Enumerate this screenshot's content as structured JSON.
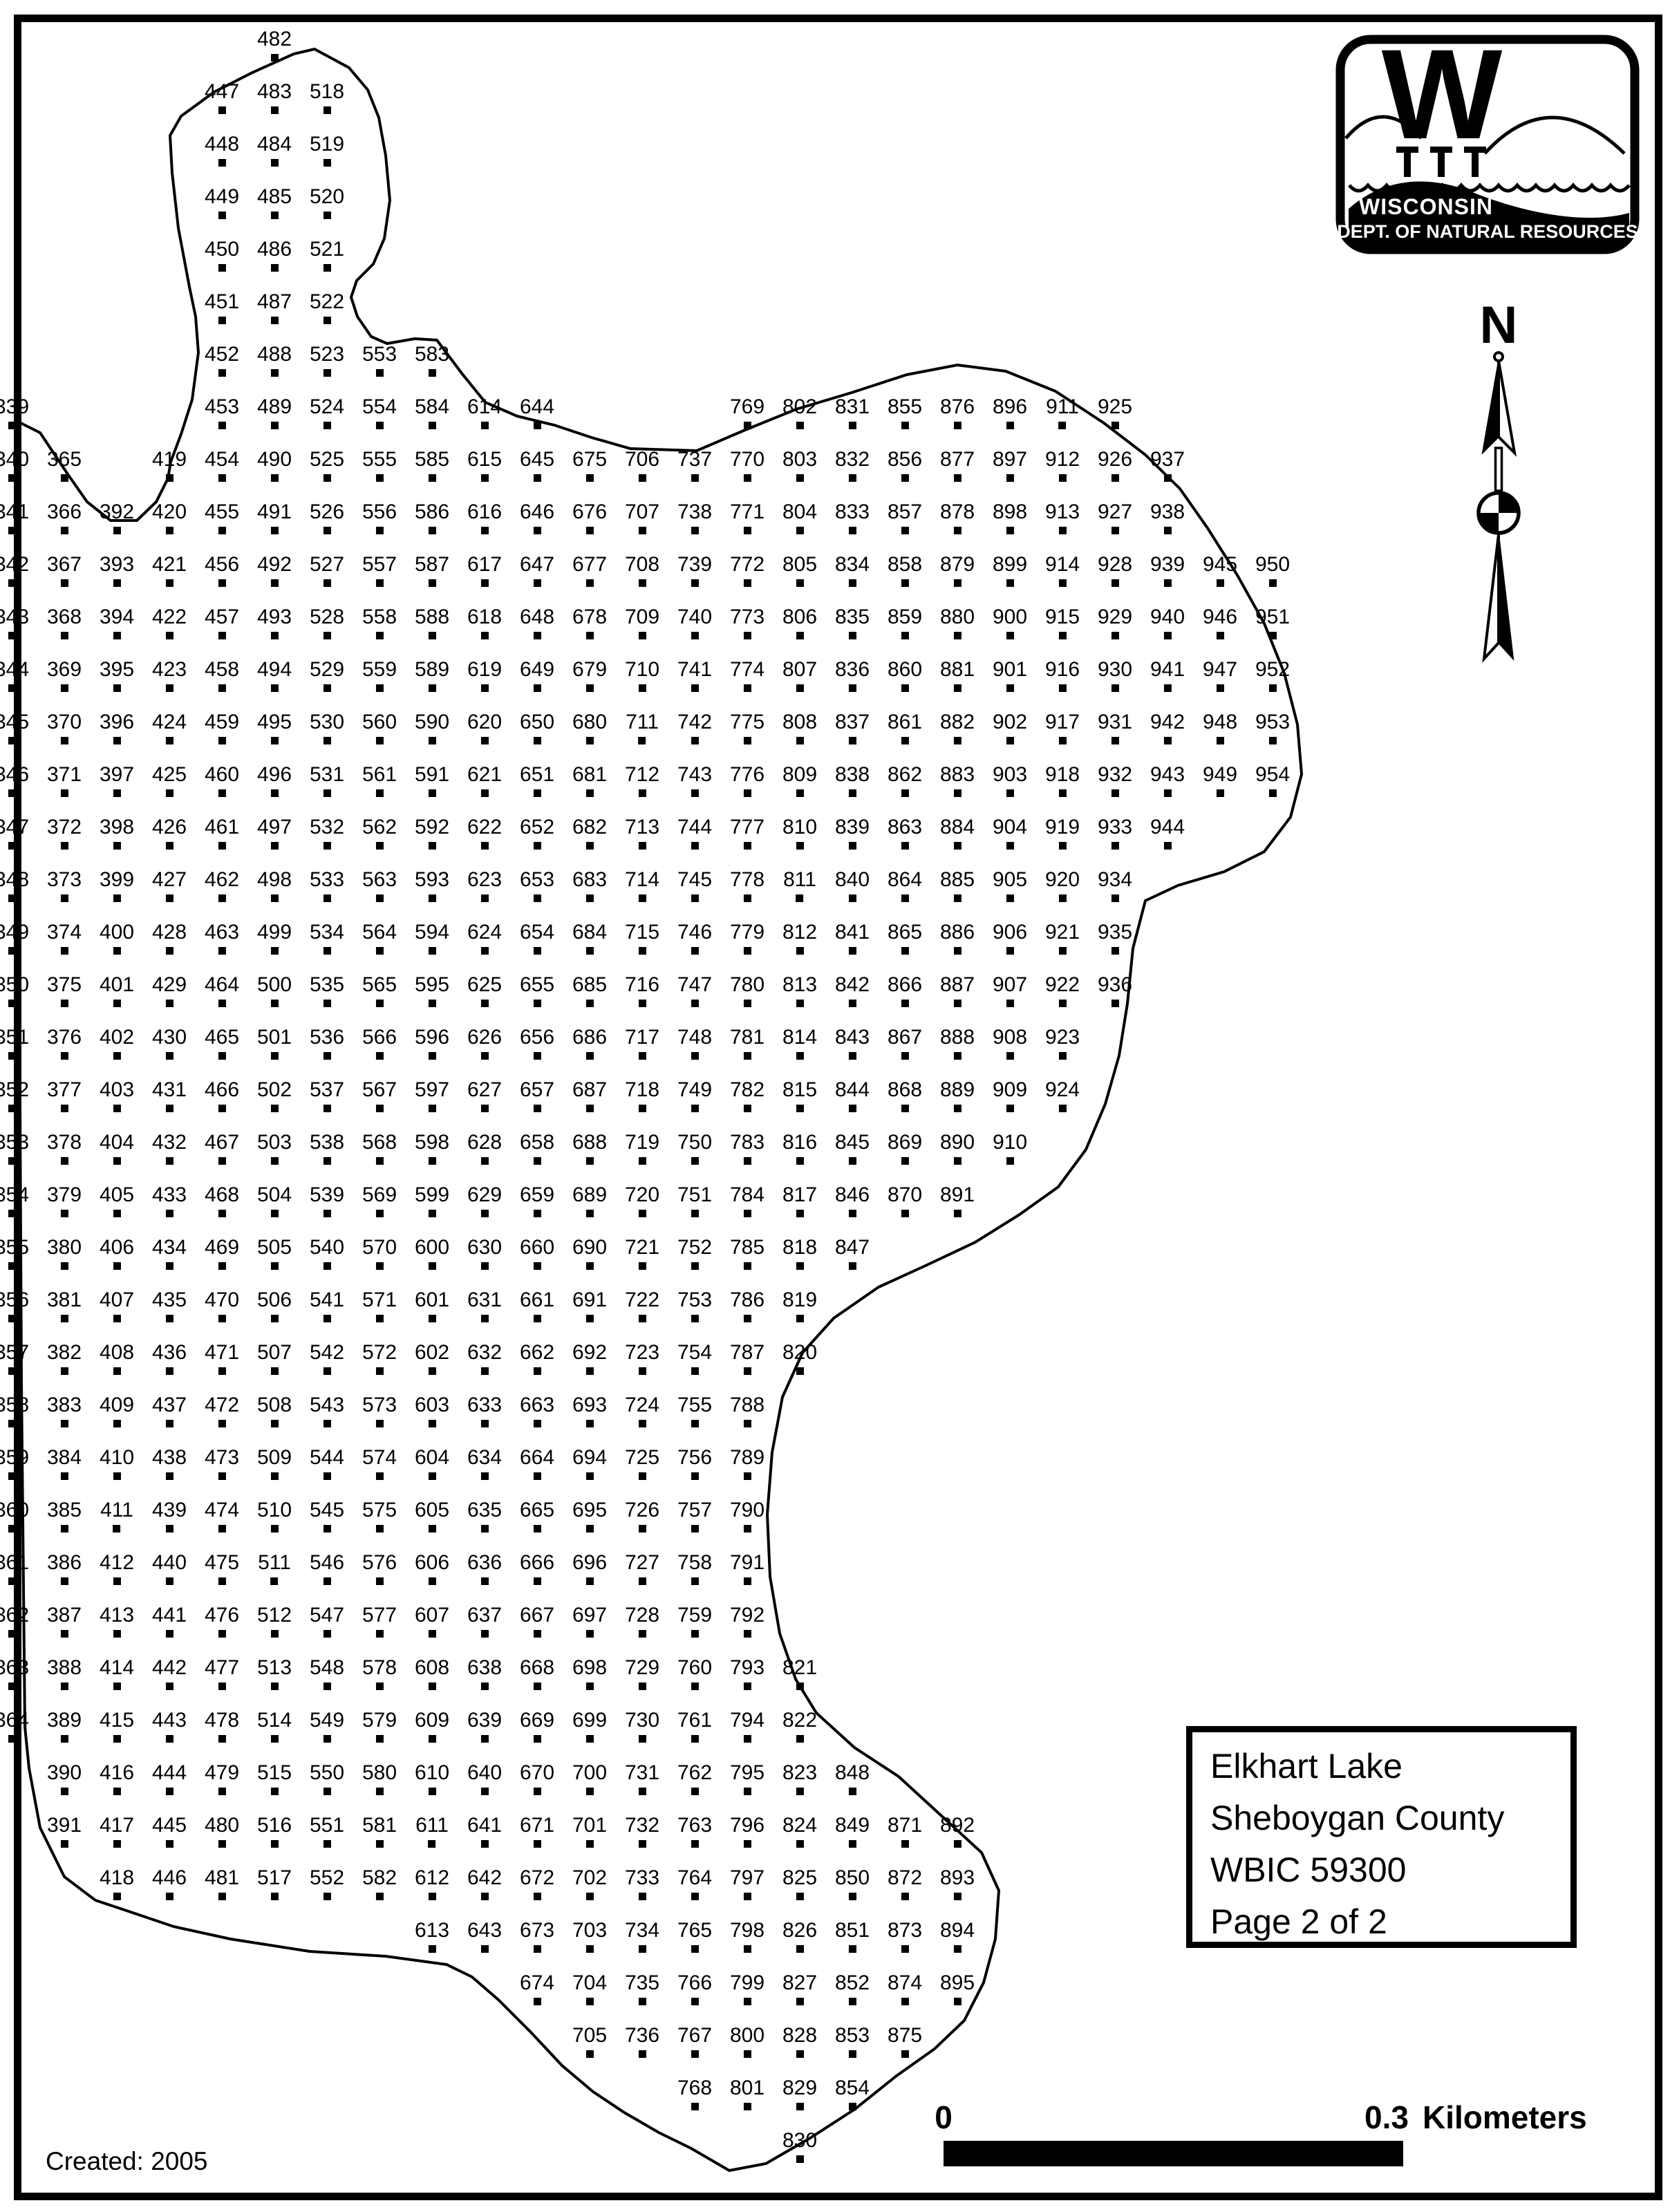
{
  "map": {
    "created_label": "Created: 2005",
    "north_label": "N",
    "info_box": {
      "lines": [
        "Elkhart Lake",
        "Sheboygan County",
        "WBIC 59300",
        "Page 2 of 2"
      ]
    },
    "scale_bar": {
      "left_label": "0",
      "right_label": "0.3",
      "unit_label": "Kilometers"
    },
    "logo": {
      "letter": "W",
      "line1": "WISCONSIN",
      "line2": "DEPT. OF NATURAL RESOURCES"
    },
    "colors": {
      "ink": "#000000",
      "paper": "#ffffff"
    },
    "grid_columns": [
      {
        "col": 1,
        "start": 339,
        "segments": [
          [
            7,
            32
          ]
        ]
      },
      {
        "col": 2,
        "start": 365,
        "segments": [
          [
            8,
            34
          ]
        ]
      },
      {
        "col": 3,
        "start": 392,
        "segments": [
          [
            9,
            35
          ]
        ]
      },
      {
        "col": 4,
        "start": 419,
        "segments": [
          [
            8,
            35
          ]
        ]
      },
      {
        "col": 5,
        "start": 447,
        "segments": [
          [
            1,
            35
          ]
        ]
      },
      {
        "col": 6,
        "start": 482,
        "segments": [
          [
            0,
            35
          ]
        ]
      },
      {
        "col": 7,
        "start": 518,
        "segments": [
          [
            1,
            35
          ]
        ]
      },
      {
        "col": 8,
        "start": 553,
        "segments": [
          [
            6,
            35
          ]
        ]
      },
      {
        "col": 9,
        "start": 583,
        "segments": [
          [
            6,
            36
          ]
        ]
      },
      {
        "col": 10,
        "start": 614,
        "segments": [
          [
            7,
            36
          ]
        ]
      },
      {
        "col": 11,
        "start": 644,
        "segments": [
          [
            7,
            37
          ]
        ]
      },
      {
        "col": 12,
        "start": 675,
        "segments": [
          [
            8,
            38
          ]
        ]
      },
      {
        "col": 13,
        "start": 706,
        "segments": [
          [
            8,
            38
          ]
        ]
      },
      {
        "col": 14,
        "start": 737,
        "segments": [
          [
            8,
            39
          ]
        ]
      },
      {
        "col": 15,
        "start": 769,
        "segments": [
          [
            7,
            39
          ]
        ]
      },
      {
        "col": 16,
        "start": 802,
        "segments": [
          [
            7,
            25
          ],
          [
            31,
            40
          ]
        ]
      },
      {
        "col": 17,
        "start": 831,
        "segments": [
          [
            7,
            23
          ],
          [
            33,
            39
          ]
        ]
      },
      {
        "col": 18,
        "start": 855,
        "segments": [
          [
            7,
            22
          ],
          [
            34,
            38
          ]
        ]
      },
      {
        "col": 19,
        "start": 876,
        "segments": [
          [
            7,
            22
          ],
          [
            34,
            37
          ]
        ]
      },
      {
        "col": 20,
        "start": 896,
        "segments": [
          [
            7,
            21
          ]
        ]
      },
      {
        "col": 21,
        "start": 911,
        "segments": [
          [
            7,
            20
          ]
        ]
      },
      {
        "col": 22,
        "start": 925,
        "segments": [
          [
            7,
            18
          ]
        ]
      },
      {
        "col": 23,
        "start": 937,
        "segments": [
          [
            8,
            15
          ]
        ]
      },
      {
        "col": 24,
        "start": 945,
        "segments": [
          [
            10,
            14
          ]
        ]
      },
      {
        "col": 25,
        "start": 950,
        "segments": [
          [
            10,
            14
          ]
        ]
      }
    ]
  }
}
